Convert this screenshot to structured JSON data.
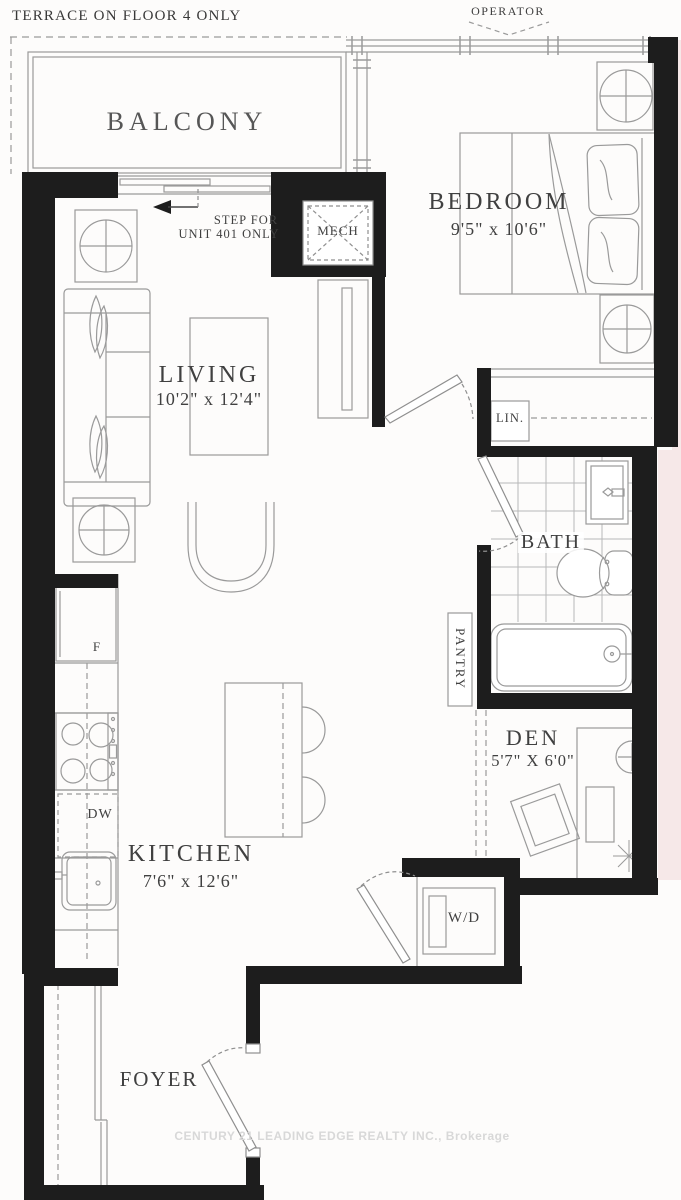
{
  "plan": {
    "notes": {
      "terrace": "TERRACE ON FLOOR 4 ONLY",
      "operator": "OPERATOR",
      "step_line1": "STEP FOR",
      "step_line2": "UNIT 401 ONLY"
    },
    "rooms": {
      "balcony": {
        "name": "BALCONY"
      },
      "bedroom": {
        "name": "BEDROOM",
        "dims": "9'5\" x 10'6\""
      },
      "living": {
        "name": "LIVING",
        "dims": "10'2\" x 12'4\""
      },
      "kitchen": {
        "name": "KITCHEN",
        "dims": "7'6\" x 12'6\""
      },
      "den": {
        "name": "DEN",
        "dims": "5'7\" X 6'0\""
      },
      "bath": {
        "name": "BATH"
      },
      "foyer": {
        "name": "FOYER"
      },
      "mech": {
        "name": "MECH"
      },
      "pantry": {
        "name": "PANTRY"
      },
      "linen": {
        "name": "LIN."
      }
    },
    "appliances": {
      "fridge": "F",
      "dishwasher": "DW",
      "washer_dryer": "W/D"
    },
    "watermark": "CENTURY 21 LEADING EDGE REALTY INC., Brokerage",
    "colors": {
      "wall": "#1d1d1d",
      "line": "#9a9a9a",
      "tile_line": "#b8b8b8",
      "text": "#404040",
      "watermark": "#d8d8d8",
      "margin_tint": "#f6e8e8"
    }
  }
}
